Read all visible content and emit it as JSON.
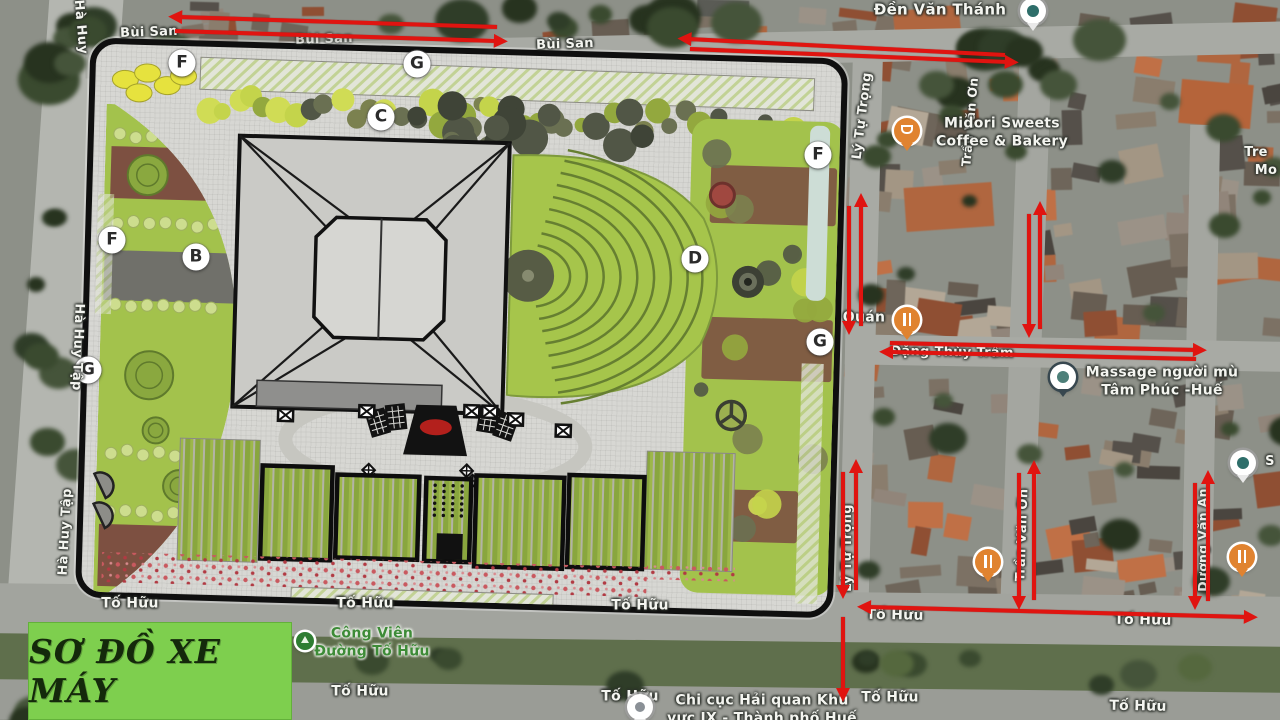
{
  "title_box": {
    "label": "SƠ ĐỒ XE MÁY",
    "bg_color": "#7ecf4e",
    "text_color": "#14290b"
  },
  "arrow_color": "#e01410",
  "plan_markers": [
    {
      "letter": "F",
      "x": 182,
      "y": 63
    },
    {
      "letter": "G",
      "x": 417,
      "y": 64
    },
    {
      "letter": "C",
      "x": 381,
      "y": 117
    },
    {
      "letter": "F",
      "x": 112,
      "y": 240
    },
    {
      "letter": "B",
      "x": 196,
      "y": 257
    },
    {
      "letter": "G",
      "x": 88,
      "y": 370
    },
    {
      "letter": "D",
      "x": 695,
      "y": 259
    },
    {
      "letter": "F",
      "x": 818,
      "y": 155
    },
    {
      "letter": "G",
      "x": 820,
      "y": 342
    }
  ],
  "street_labels": [
    {
      "text": "Hà Huy",
      "x": 80,
      "y": 27,
      "rot": 85,
      "fs": 13
    },
    {
      "text": "Bùi San",
      "x": 149,
      "y": 33,
      "rot": -2,
      "fs": 13
    },
    {
      "text": "Bùi San",
      "x": 324,
      "y": 40,
      "rot": -2,
      "fs": 13,
      "op": 0.65
    },
    {
      "text": "Bùi San",
      "x": 565,
      "y": 45,
      "rot": -2,
      "fs": 13
    },
    {
      "text": "Lý Tự Trọng",
      "x": 863,
      "y": 116,
      "rot": -83,
      "fs": 13
    },
    {
      "text": "Trần Văn Ơn",
      "x": 970,
      "y": 122,
      "rot": -85,
      "fs": 12.5
    },
    {
      "text": "Tre",
      "x": 1256,
      "y": 153,
      "rot": 0,
      "fs": 13
    },
    {
      "text": "Mo",
      "x": 1266,
      "y": 171,
      "rot": 0,
      "fs": 13
    },
    {
      "text": "Đặng Thùy Trâm",
      "x": 952,
      "y": 353,
      "rot": 1,
      "fs": 13
    },
    {
      "text": "Hà Huy Tập",
      "x": 77,
      "y": 347,
      "rot": 92,
      "fs": 13
    },
    {
      "text": "Hà Huy Tập",
      "x": 66,
      "y": 532,
      "rot": -87,
      "fs": 13
    },
    {
      "text": "Lý Tự Trọng",
      "x": 848,
      "y": 548,
      "rot": -90,
      "fs": 13
    },
    {
      "text": "Trần Văn Ơn",
      "x": 1023,
      "y": 535,
      "rot": -88,
      "fs": 13
    },
    {
      "text": "Dương Văn An",
      "x": 1203,
      "y": 540,
      "rot": -90,
      "fs": 12.5,
      "op": 0.9
    },
    {
      "text": "S",
      "x": 1270,
      "y": 462,
      "rot": 0,
      "fs": 13
    },
    {
      "text": "Tố Hữu",
      "x": 130,
      "y": 604,
      "rot": 0,
      "fs": 14
    },
    {
      "text": "Tố Hữu",
      "x": 365,
      "y": 604,
      "rot": 0,
      "fs": 14
    },
    {
      "text": "Tố Hữu",
      "x": 640,
      "y": 606,
      "rot": 0,
      "fs": 14
    },
    {
      "text": "Tố Hữu",
      "x": 895,
      "y": 616,
      "rot": 1,
      "fs": 14
    },
    {
      "text": "Tố Hữu",
      "x": 1143,
      "y": 621,
      "rot": 1,
      "fs": 14
    },
    {
      "text": "Tố Hữu",
      "x": 360,
      "y": 692,
      "rot": 0,
      "fs": 14
    },
    {
      "text": "Tố Hữu",
      "x": 630,
      "y": 697,
      "rot": 0,
      "fs": 14
    },
    {
      "text": "Tố Hữu",
      "x": 890,
      "y": 698,
      "rot": 0,
      "fs": 14
    },
    {
      "text": "Tố Hữu",
      "x": 1138,
      "y": 707,
      "rot": 1,
      "fs": 14
    }
  ],
  "pois": [
    {
      "name": "den-van-thanh",
      "label": "Đền Văn Thánh",
      "lx": 940,
      "ly": 10,
      "px": 1033,
      "py": 11,
      "type": "temple-pin",
      "fs": 15
    },
    {
      "name": "midori-sweets",
      "label": "Midori Sweets\nCoffee & Bakery",
      "lx": 1002,
      "ly": 133,
      "px": 907,
      "py": 131,
      "type": "cafe-pin",
      "fs": 14
    },
    {
      "name": "quan-restaurant",
      "label": "Quán",
      "lx": 864,
      "ly": 318,
      "px": 907,
      "py": 320,
      "type": "restaurant-pin",
      "fs": 14
    },
    {
      "name": "massage-tam-phuc",
      "label": "Massage người mù\nTâm Phúc -Huế",
      "lx": 1162,
      "ly": 382,
      "px": 1063,
      "py": 377,
      "type": "massage-pin",
      "fs": 14
    },
    {
      "name": "restaurant-south",
      "label": "",
      "lx": 0,
      "ly": 0,
      "px": 988,
      "py": 562,
      "type": "restaurant-pin",
      "fs": 14
    },
    {
      "name": "restaurant-east",
      "label": "",
      "lx": 0,
      "ly": 0,
      "px": 1242,
      "py": 557,
      "type": "restaurant-pin",
      "fs": 14
    },
    {
      "name": "health-place",
      "label": "",
      "lx": 0,
      "ly": 0,
      "px": 1243,
      "py": 463,
      "type": "health-pin",
      "fs": 13
    },
    {
      "name": "cong-vien-to-huu",
      "label": "Công Viên\nĐường Tố Hữu",
      "lx": 372,
      "ly": 643,
      "px": 305,
      "py": 641,
      "type": "park-dot",
      "green": true,
      "fs": 14
    },
    {
      "name": "chi-cuc-hai-quan",
      "label": "Chi cục Hải quan Khu\nvực IX - Thành phố Huế",
      "lx": 762,
      "ly": 710,
      "px": 640,
      "py": 707,
      "type": "gov-pin",
      "fs": 14
    }
  ],
  "arrows": [
    {
      "x1": 497,
      "y1": 27,
      "x2": 179,
      "y2": 17
    },
    {
      "x1": 175,
      "y1": 31,
      "x2": 497,
      "y2": 41
    },
    {
      "x1": 1005,
      "y1": 55,
      "x2": 688,
      "y2": 39
    },
    {
      "x1": 690,
      "y1": 49,
      "x2": 1008,
      "y2": 62
    },
    {
      "x1": 861,
      "y1": 326,
      "x2": 861,
      "y2": 204
    },
    {
      "x1": 849,
      "y1": 206,
      "x2": 849,
      "y2": 324
    },
    {
      "x1": 1040,
      "y1": 329,
      "x2": 1040,
      "y2": 212
    },
    {
      "x1": 1029,
      "y1": 214,
      "x2": 1029,
      "y2": 327
    },
    {
      "x1": 890,
      "y1": 343,
      "x2": 1196,
      "y2": 350
    },
    {
      "x1": 1196,
      "y1": 359,
      "x2": 890,
      "y2": 352
    },
    {
      "x1": 856,
      "y1": 590,
      "x2": 856,
      "y2": 470
    },
    {
      "x1": 843,
      "y1": 472,
      "x2": 843,
      "y2": 588
    },
    {
      "x1": 1034,
      "y1": 600,
      "x2": 1034,
      "y2": 471
    },
    {
      "x1": 1019,
      "y1": 473,
      "x2": 1019,
      "y2": 599
    },
    {
      "x1": 1208,
      "y1": 601,
      "x2": 1208,
      "y2": 481
    },
    {
      "x1": 1195,
      "y1": 483,
      "x2": 1195,
      "y2": 599
    },
    {
      "x1": 868,
      "y1": 607,
      "x2": 1247,
      "y2": 617,
      "head": "both"
    },
    {
      "x1": 843,
      "y1": 617,
      "x2": 843,
      "y2": 691
    }
  ]
}
